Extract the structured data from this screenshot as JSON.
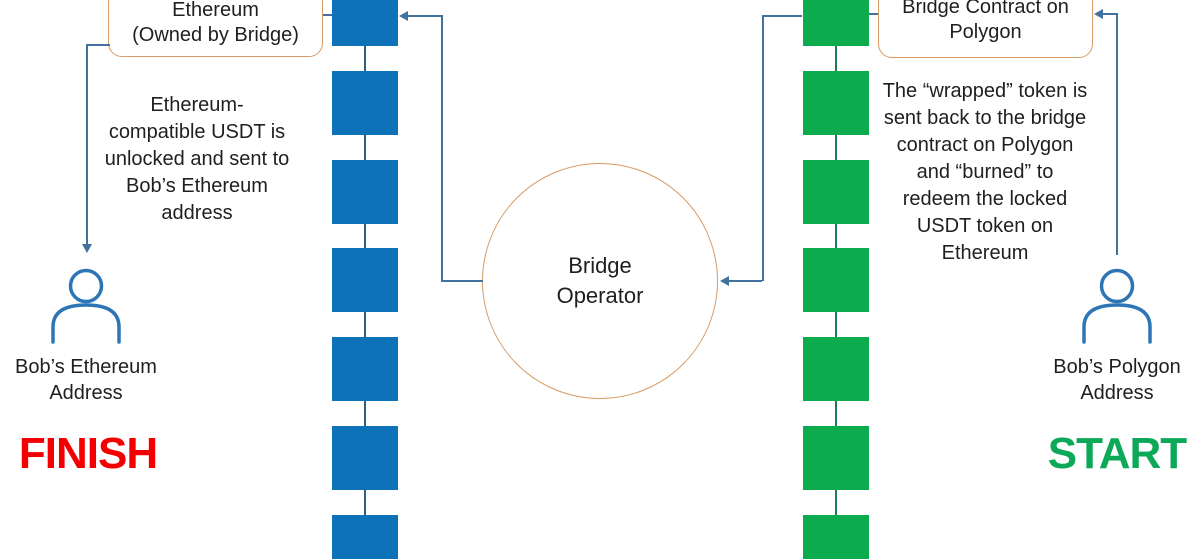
{
  "colors": {
    "text": "#1f1f1f",
    "arrow": "#41719C",
    "box_border": "#D99B66",
    "person": "#2E75B6",
    "finish": "#F40000",
    "start": "#0DA858"
  },
  "chains": {
    "ethereum": {
      "name": "ethereum-blockchain",
      "blocks": 7,
      "block_color": "#0E72B9",
      "link_color": "#2E5E80"
    },
    "polygon": {
      "name": "polygon-blockchain",
      "blocks": 7,
      "block_color": "#0CAC4E",
      "link_color": "#1B7E57"
    }
  },
  "boxes": {
    "eth_contract": "Ethereum\n(Owned by Bridge)",
    "poly_contract": "Bridge Contract on\nPolygon"
  },
  "notes": {
    "finish_note": "Ethereum-\ncompatible USDT is\nunlocked and sent to\nBob’s Ethereum\naddress",
    "start_note": "The “wrapped” token is\nsent back to the bridge\ncontract on Polygon\nand “burned” to\nredeem the locked\nUSDT token on\nEthereum"
  },
  "bridge_operator_label": "Bridge\nOperator",
  "actors": {
    "ethereum": {
      "label": "Bob’s Ethereum\nAddress",
      "marker": "FINISH"
    },
    "polygon": {
      "label": "Bob’s Polygon\nAddress",
      "marker": "START"
    }
  }
}
